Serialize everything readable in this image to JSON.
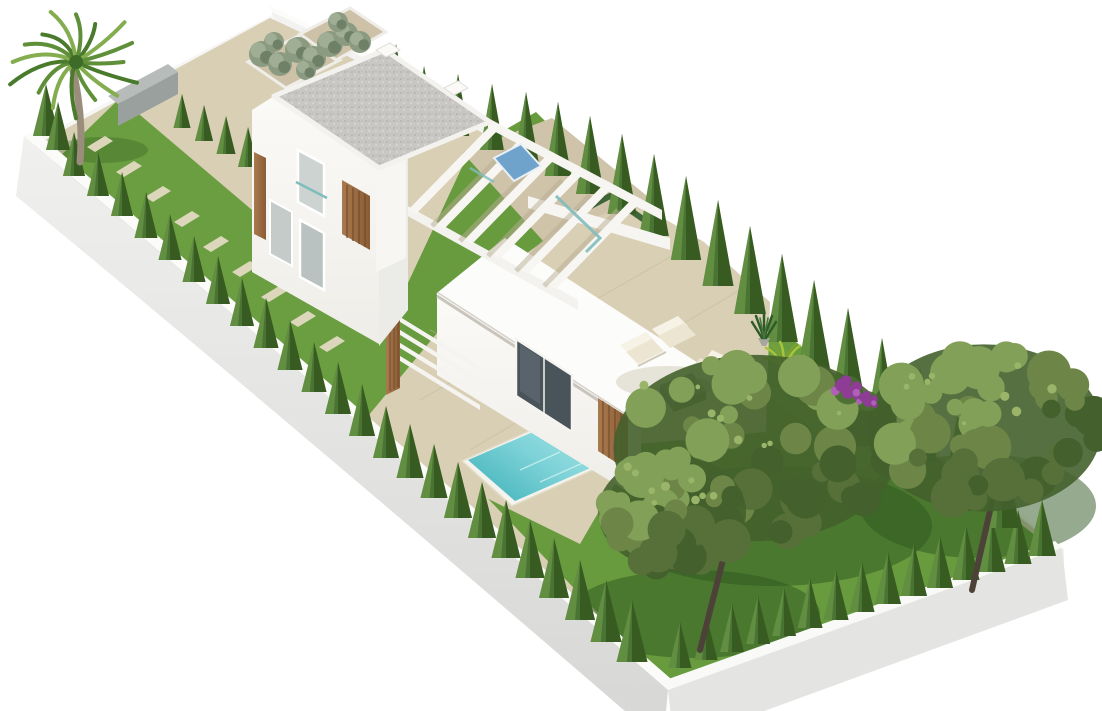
{
  "meta": {
    "type": "3d-architectural-render",
    "subject": "Aerial oblique render of a modern two-storey white villa plot with pool and landscaped garden",
    "background": "#ffffff"
  },
  "palette": {
    "white": "#ffffff",
    "paving": "#d9cfb5",
    "paving_shade": "#cfc4a9",
    "joint": "#c2b79c",
    "lawn": "#679b3e",
    "lawn_light": "#7cad4d",
    "lawn_dark": "#3c6526",
    "shadow_green": "#2e5520",
    "wall_face": "#ededeb",
    "wall_face_dark": "#d7d7d5",
    "wall_top": "#fbfbf9",
    "wall_inner": "#f5f5f3",
    "gate": "#585d61",
    "house": "#faf9f6",
    "house_shade": "#ebebe7",
    "parapet": "#f3f2ef",
    "gravel": "#c8c7c3",
    "gravel_dark": "#b5b4b0",
    "gravel_light": "#d8d7d3",
    "wood": "#9b6c43",
    "wood_dark": "#744c2a",
    "glass": "#ccd3d1",
    "glass_dark": "#49535a",
    "glass_teal": "#7fbdbc",
    "glass_blue": "#6fa3cc",
    "pool_light": "#ace6e7",
    "pool_deep": "#4fb9c1",
    "coping": "#f5f3ed",
    "cream": "#f6f2e6",
    "cushion": "#ece5d2",
    "table_top": "#8d8d89",
    "table_side": "#6e6e6a",
    "cypress_dark": "#35571f",
    "cypress_mid": "#4a7434",
    "cypress_light": "#6c9a47",
    "canopy_dark": "#44602c",
    "canopy_mid": "#57703a",
    "canopy_olive": "#6d8648",
    "canopy_light": "#82a057",
    "canopy_glow": "#9ab56a",
    "trunk": "#4c4238",
    "palm_trunk": "#9a8d7c",
    "shrub": "#8b9b81",
    "shrub_dark": "#6f8068",
    "purple": "#8e3c96",
    "purple_light": "#b060b8"
  },
  "scene": {
    "objects": [
      {
        "name": "perimeter-wall",
        "description": "white rendered wall around rectangular plot"
      },
      {
        "name": "entrance-gate",
        "description": "dark grey slatted gate panels in rear wall"
      },
      {
        "name": "palm-tree",
        "description": "fan palm at top-left plot corner"
      },
      {
        "name": "side-lawn-strip",
        "description": "lawn strip with stepping stones and cypress hedge"
      },
      {
        "name": "two-storey-villa",
        "description": "white modern villa with gravel flat roof and wood slat panels"
      },
      {
        "name": "pergola",
        "description": "white beam pergola over upper terrace"
      },
      {
        "name": "single-storey-annex",
        "description": "white annex with sliding glass door"
      },
      {
        "name": "swimming-pool",
        "description": "turquoise rectangular pool with white coping"
      },
      {
        "name": "sun-terrace",
        "description": "beige paved terrace with cream lounge chairs and grey coffee table"
      },
      {
        "name": "main-lawn",
        "description": "large lawn with two mature pine trees"
      },
      {
        "name": "cypress-row",
        "description": "tall cypress screen along rear boundary"
      },
      {
        "name": "bougainvillea",
        "description": "purple flowering shrub at lawn edge"
      }
    ],
    "ne_cypress_row": [
      [
        396,
        102,
        58
      ],
      [
        424,
        124,
        58
      ],
      [
        458,
        136,
        62
      ],
      [
        492,
        150,
        66
      ],
      [
        526,
        162,
        70
      ],
      [
        558,
        176,
        74
      ],
      [
        590,
        194,
        78
      ],
      [
        622,
        214,
        80
      ],
      [
        654,
        236,
        82
      ],
      [
        686,
        260,
        84
      ],
      [
        718,
        286,
        86
      ],
      [
        750,
        314,
        88
      ],
      [
        782,
        342,
        88
      ],
      [
        814,
        370,
        90
      ],
      [
        848,
        400,
        92
      ],
      [
        882,
        430,
        92
      ],
      [
        920,
        462,
        94
      ],
      [
        960,
        496,
        96
      ],
      [
        1002,
        528,
        98
      ]
    ],
    "sw_hedge": [
      [
        46,
        136,
        52
      ],
      [
        58,
        150,
        48
      ],
      [
        74,
        176,
        44
      ],
      [
        98,
        196,
        44
      ],
      [
        122,
        216,
        44
      ],
      [
        146,
        238,
        46
      ],
      [
        170,
        260,
        46
      ],
      [
        194,
        282,
        46
      ],
      [
        218,
        304,
        48
      ],
      [
        242,
        326,
        48
      ],
      [
        266,
        348,
        50
      ],
      [
        290,
        370,
        50
      ],
      [
        314,
        392,
        50
      ],
      [
        338,
        414,
        52
      ],
      [
        362,
        436,
        52
      ],
      [
        386,
        458,
        52
      ],
      [
        410,
        478,
        54
      ],
      [
        434,
        498,
        54
      ],
      [
        458,
        518,
        56
      ],
      [
        482,
        538,
        56
      ],
      [
        506,
        558,
        58
      ],
      [
        530,
        578,
        58
      ],
      [
        554,
        598,
        60
      ],
      [
        580,
        620,
        60
      ],
      [
        606,
        642,
        62
      ],
      [
        632,
        662,
        62
      ]
    ],
    "se_hedge": [
      [
        680,
        668,
        46
      ],
      [
        706,
        660,
        46
      ],
      [
        732,
        652,
        48
      ],
      [
        758,
        644,
        48
      ],
      [
        784,
        636,
        48
      ],
      [
        810,
        628,
        50
      ],
      [
        836,
        620,
        50
      ],
      [
        862,
        612,
        50
      ],
      [
        888,
        604,
        52
      ],
      [
        914,
        596,
        52
      ],
      [
        940,
        588,
        52
      ],
      [
        966,
        580,
        54
      ],
      [
        992,
        572,
        54
      ],
      [
        1018,
        564,
        54
      ],
      [
        1042,
        556,
        56
      ]
    ],
    "path_cypresses": [
      [
        182,
        128,
        34
      ],
      [
        204,
        141,
        36
      ],
      [
        226,
        154,
        38
      ],
      [
        248,
        167,
        40
      ]
    ],
    "stepping_stones": [
      [
        100,
        144
      ],
      [
        129,
        169
      ],
      [
        158,
        194
      ],
      [
        187,
        219
      ],
      [
        216,
        244
      ],
      [
        245,
        269
      ],
      [
        274,
        294
      ],
      [
        303,
        319
      ],
      [
        332,
        344
      ]
    ],
    "trees": [
      {
        "cx": 756,
        "cy": 448,
        "rx": 150,
        "ry": 98,
        "seed": 7,
        "trunk": [
          700,
          650,
          724,
          556
        ]
      },
      {
        "cx": 984,
        "cy": 428,
        "rx": 124,
        "ry": 88,
        "seed": 23,
        "trunk": [
          972,
          590,
          992,
          502
        ]
      },
      {
        "cx": 672,
        "cy": 512,
        "rx": 78,
        "ry": 60,
        "seed": 41,
        "trunk": null
      }
    ],
    "tree_shadows": [
      [
        772,
        526,
        160,
        60
      ],
      [
        978,
        506,
        118,
        52
      ],
      [
        694,
        614,
        126,
        44
      ]
    ],
    "palm": {
      "cx": 76,
      "cy": 62,
      "frond_count": 16,
      "frond_len": 66,
      "trunk": [
        [
          80,
          162
        ],
        [
          72,
          66
        ]
      ],
      "shadow": [
        102,
        150,
        46,
        13
      ]
    },
    "shrub_clusters": [
      [
        262,
        54,
        13
      ],
      [
        280,
        64,
        12
      ],
      [
        298,
        50,
        13
      ],
      [
        314,
        58,
        12
      ],
      [
        330,
        44,
        13
      ],
      [
        346,
        34,
        12
      ],
      [
        360,
        42,
        11
      ],
      [
        274,
        42,
        10
      ],
      [
        306,
        70,
        10
      ],
      [
        338,
        22,
        10
      ]
    ],
    "bougainvillea_dots": [
      [
        848,
        390,
        16
      ],
      [
        868,
        401,
        11
      ]
    ]
  }
}
